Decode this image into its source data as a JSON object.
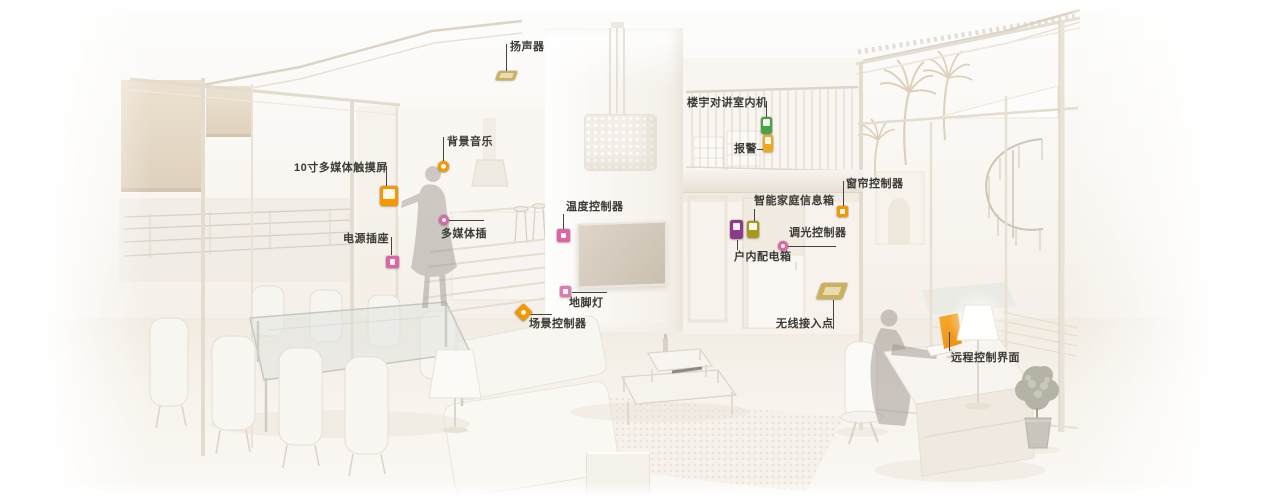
{
  "meta": {
    "description": "智能家居系统户型标注图 — annotated rendering of a smart-home interior with labeled devices"
  },
  "palette": {
    "orange": "#f39800",
    "magenta": "#dc66a5",
    "green": "#4ba145",
    "olive": "#a79a1c",
    "purple": "#8c3b8c",
    "gold": "#cdb05a",
    "label_text": "#3a3935",
    "leader_line": "#45443f",
    "screen_orange": "#f0970f"
  },
  "annotations": [
    {
      "id": "speaker",
      "label": "扬声器",
      "label_x": 510,
      "label_y": 41,
      "line": {
        "x1": 506,
        "y1": 44,
        "x2": 506,
        "y2": 71
      },
      "icon": {
        "name": "speaker-icon",
        "shape": "plate",
        "x": 497,
        "y": 71,
        "w": 19,
        "h": 9,
        "color": "#cdb05a"
      }
    },
    {
      "id": "background-music",
      "label": "背景音乐",
      "label_x": 447,
      "label_y": 136,
      "line": {
        "x1": 443,
        "y1": 137,
        "x2": 443,
        "y2": 161
      },
      "icon": {
        "name": "background-music-icon",
        "shape": "circle",
        "x": 438,
        "y": 161,
        "w": 11,
        "h": 11,
        "color": "#f39800"
      }
    },
    {
      "id": "touchscreen",
      "label": "10寸多媒体触摸屏",
      "label_x": 294,
      "label_y": 162,
      "line": {
        "x1": 386,
        "y1": 166,
        "x2": 386,
        "y2": 186
      },
      "icon": {
        "name": "touchscreen-icon",
        "shape": "panel",
        "x": 380,
        "y": 186,
        "w": 18,
        "h": 20,
        "color": "#f39800"
      }
    },
    {
      "id": "power-socket",
      "label": "电源插座",
      "label_x": 343,
      "label_y": 233,
      "line": {
        "x1": 391,
        "y1": 237,
        "x2": 391,
        "y2": 255
      },
      "icon": {
        "name": "power-socket-icon",
        "shape": "square",
        "x": 386,
        "y": 256,
        "w": 13,
        "h": 12,
        "color": "#dc66a5"
      }
    },
    {
      "id": "multimedia-socket",
      "label": "多媒体插",
      "label_x": 441,
      "label_y": 228,
      "line": {
        "x1": 449,
        "y1": 220,
        "x2": 484,
        "y2": 220
      },
      "icon": {
        "name": "multimedia-socket-icon",
        "shape": "circle",
        "x": 439,
        "y": 215,
        "w": 10,
        "h": 10,
        "color": "#dc66a5"
      }
    },
    {
      "id": "thermostat",
      "label": "温度控制器",
      "label_x": 566,
      "label_y": 201,
      "line": {
        "x1": 563,
        "y1": 214,
        "x2": 563,
        "y2": 229
      },
      "icon": {
        "name": "thermostat-icon",
        "shape": "square",
        "x": 557,
        "y": 229,
        "w": 13,
        "h": 13,
        "color": "#dc66a5"
      }
    },
    {
      "id": "footlight",
      "label": "地脚灯",
      "label_x": 569,
      "label_y": 297,
      "line": {
        "x1": 572,
        "y1": 292,
        "x2": 607,
        "y2": 292
      },
      "icon": {
        "name": "footlight-icon",
        "shape": "square",
        "x": 560,
        "y": 286,
        "w": 11,
        "h": 11,
        "color": "#e07ab2"
      }
    },
    {
      "id": "scene-controller",
      "label": "场景控制器",
      "label_x": 529,
      "label_y": 318,
      "line": {
        "x1": 529,
        "y1": 314,
        "x2": 552,
        "y2": 314
      },
      "icon": {
        "name": "scene-controller-icon",
        "shape": "diamond",
        "x": 517,
        "y": 306,
        "w": 13,
        "h": 13,
        "color": "#f39800"
      }
    },
    {
      "id": "intercom",
      "label": "楼宇对讲室内机",
      "label_x": 687,
      "label_y": 97,
      "line": {
        "x1": 766,
        "y1": 101,
        "x2": 766,
        "y2": 117
      },
      "icon": {
        "name": "intercom-icon",
        "shape": "vrect",
        "x": 761,
        "y": 117,
        "w": 11,
        "h": 17,
        "color": "#4ba145"
      }
    },
    {
      "id": "alarm",
      "label": "报警",
      "label_x": 734,
      "label_y": 143,
      "line": {
        "x1": 757,
        "y1": 149,
        "x2": 763,
        "y2": 149
      },
      "icon": {
        "name": "alarm-icon",
        "shape": "vrect",
        "x": 763,
        "y": 135,
        "w": 10,
        "h": 17,
        "color": "#f0a81c"
      }
    },
    {
      "id": "curtain-controller",
      "label": "窗帘控制器",
      "label_x": 846,
      "label_y": 178,
      "line": {
        "x1": 843,
        "y1": 181,
        "x2": 843,
        "y2": 206
      },
      "icon": {
        "name": "curtain-controller-icon",
        "shape": "square",
        "x": 837,
        "y": 206,
        "w": 11,
        "h": 11,
        "color": "#f39800"
      }
    },
    {
      "id": "smart-home-infobox",
      "label": "智能家庭信息箱",
      "label_x": 754,
      "label_y": 195,
      "line": {
        "x1": 754,
        "y1": 209,
        "x2": 754,
        "y2": 221
      },
      "icon": {
        "name": "smart-home-infobox-icon",
        "shape": "vrect",
        "x": 747,
        "y": 221,
        "w": 12,
        "h": 17,
        "color": "#a79a1c"
      }
    },
    {
      "id": "distribution-box",
      "label": "户内配电箱",
      "label_x": 734,
      "label_y": 251,
      "line": {
        "x1": 737,
        "y1": 240,
        "x2": 737,
        "y2": 250
      },
      "icon": {
        "name": "distribution-box-icon",
        "shape": "vrect",
        "x": 730,
        "y": 220,
        "w": 13,
        "h": 19,
        "color": "#8c3b8c"
      }
    },
    {
      "id": "dimmer-controller",
      "label": "调光控制器",
      "label_x": 789,
      "label_y": 227,
      "line": {
        "x1": 788,
        "y1": 246,
        "x2": 836,
        "y2": 246
      },
      "icon": {
        "name": "dimmer-controller-icon",
        "shape": "circle",
        "x": 778,
        "y": 241,
        "w": 10,
        "h": 10,
        "color": "#dc66a5"
      }
    },
    {
      "id": "wireless-ap",
      "label": "无线接入点",
      "label_x": 776,
      "label_y": 318,
      "line": {
        "x1": 833,
        "y1": 300,
        "x2": 833,
        "y2": 329
      },
      "icon": {
        "name": "wireless-ap-icon",
        "shape": "plate",
        "x": 819,
        "y": 283,
        "w": 26,
        "h": 16,
        "color": "#cdb05a"
      }
    },
    {
      "id": "remote-ui",
      "label": "远程控制界面",
      "label_x": 951,
      "label_y": 352,
      "line": {
        "x1": 949,
        "y1": 332,
        "x2": 949,
        "y2": 351
      },
      "icon": null
    }
  ]
}
